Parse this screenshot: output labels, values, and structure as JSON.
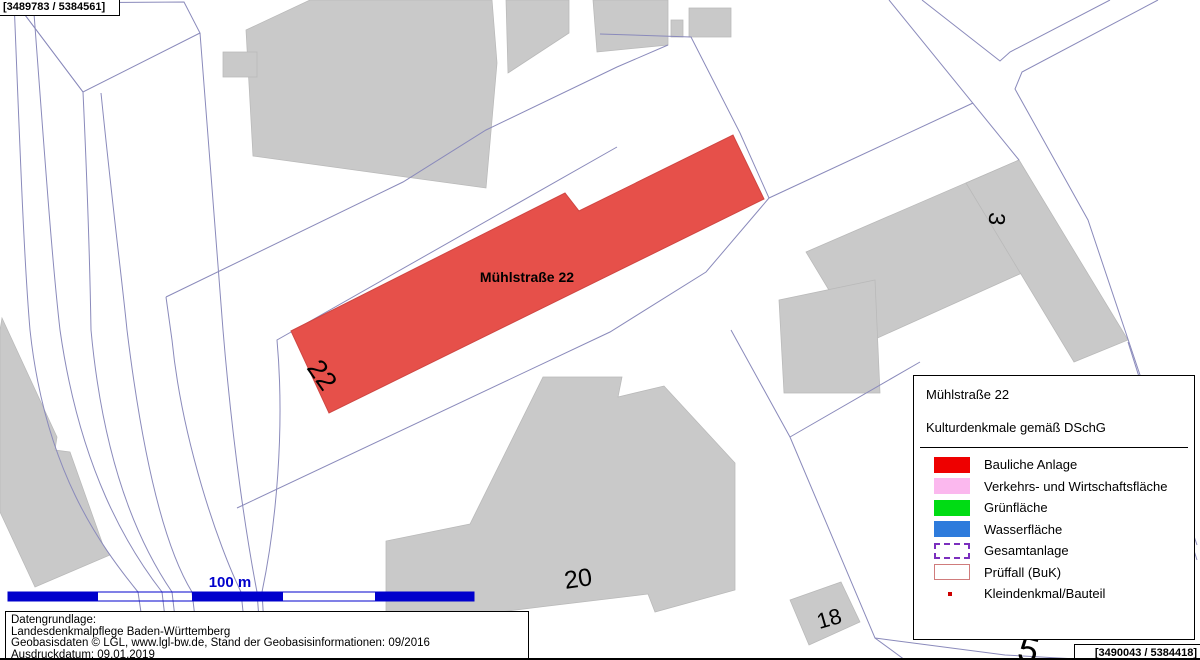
{
  "coordinates": {
    "top_left": "[3489783 / 5384561]",
    "bottom_right": "[3490043 / 5384418]"
  },
  "map": {
    "street_label": "Mühlstraße 22",
    "numbers": {
      "n22": "22",
      "n3": "3",
      "n20": "20",
      "n18": "18",
      "n5": "5"
    }
  },
  "scalebar": {
    "label": "100 m"
  },
  "legend": {
    "title": "Mühlstraße 22",
    "subtitle": "Kulturdenkmale gemäß DSchG",
    "items": [
      {
        "label": "Bauliche Anlage",
        "swatch": "red"
      },
      {
        "label": "Verkehrs- und Wirtschaftsfläche",
        "swatch": "pink"
      },
      {
        "label": "Grünfläche",
        "swatch": "green"
      },
      {
        "label": "Wasserfläche",
        "swatch": "blue"
      },
      {
        "label": "Gesamtanlage",
        "swatch": "dashed-purple"
      },
      {
        "label": "Prüffall (BuK)",
        "swatch": "outline-salmon"
      },
      {
        "label": "Kleindenkmal/Bauteil",
        "swatch": "dot-red"
      }
    ]
  },
  "source_box": {
    "line1": "Datengrundlage:",
    "line2": "Landesdenkmalpflege Baden-Württemberg",
    "line3": "Geobasisdaten © LGL, www.lgl-bw.de, Stand der Geobasisinformationen: 09/2016",
    "line4": "Ausdruckdatum: 09.01.2019"
  },
  "colors": {
    "monument-red": "#E6504A",
    "building-gray": "#C9C9C9",
    "parcel-line": "#8A8ABB",
    "scalebar-blue": "#0000CC",
    "legend-red": "#EE0000",
    "legend-pink": "#FBB8EE",
    "legend-green": "#00DC14",
    "legend-blue": "#2E7BDC",
    "gesamtanlage-purple": "#7B2FBE",
    "prueffall-salmon": "#D07C7C",
    "kleindenkmal-red": "#CC0000",
    "number-dark-red": "#8B1A1A"
  }
}
